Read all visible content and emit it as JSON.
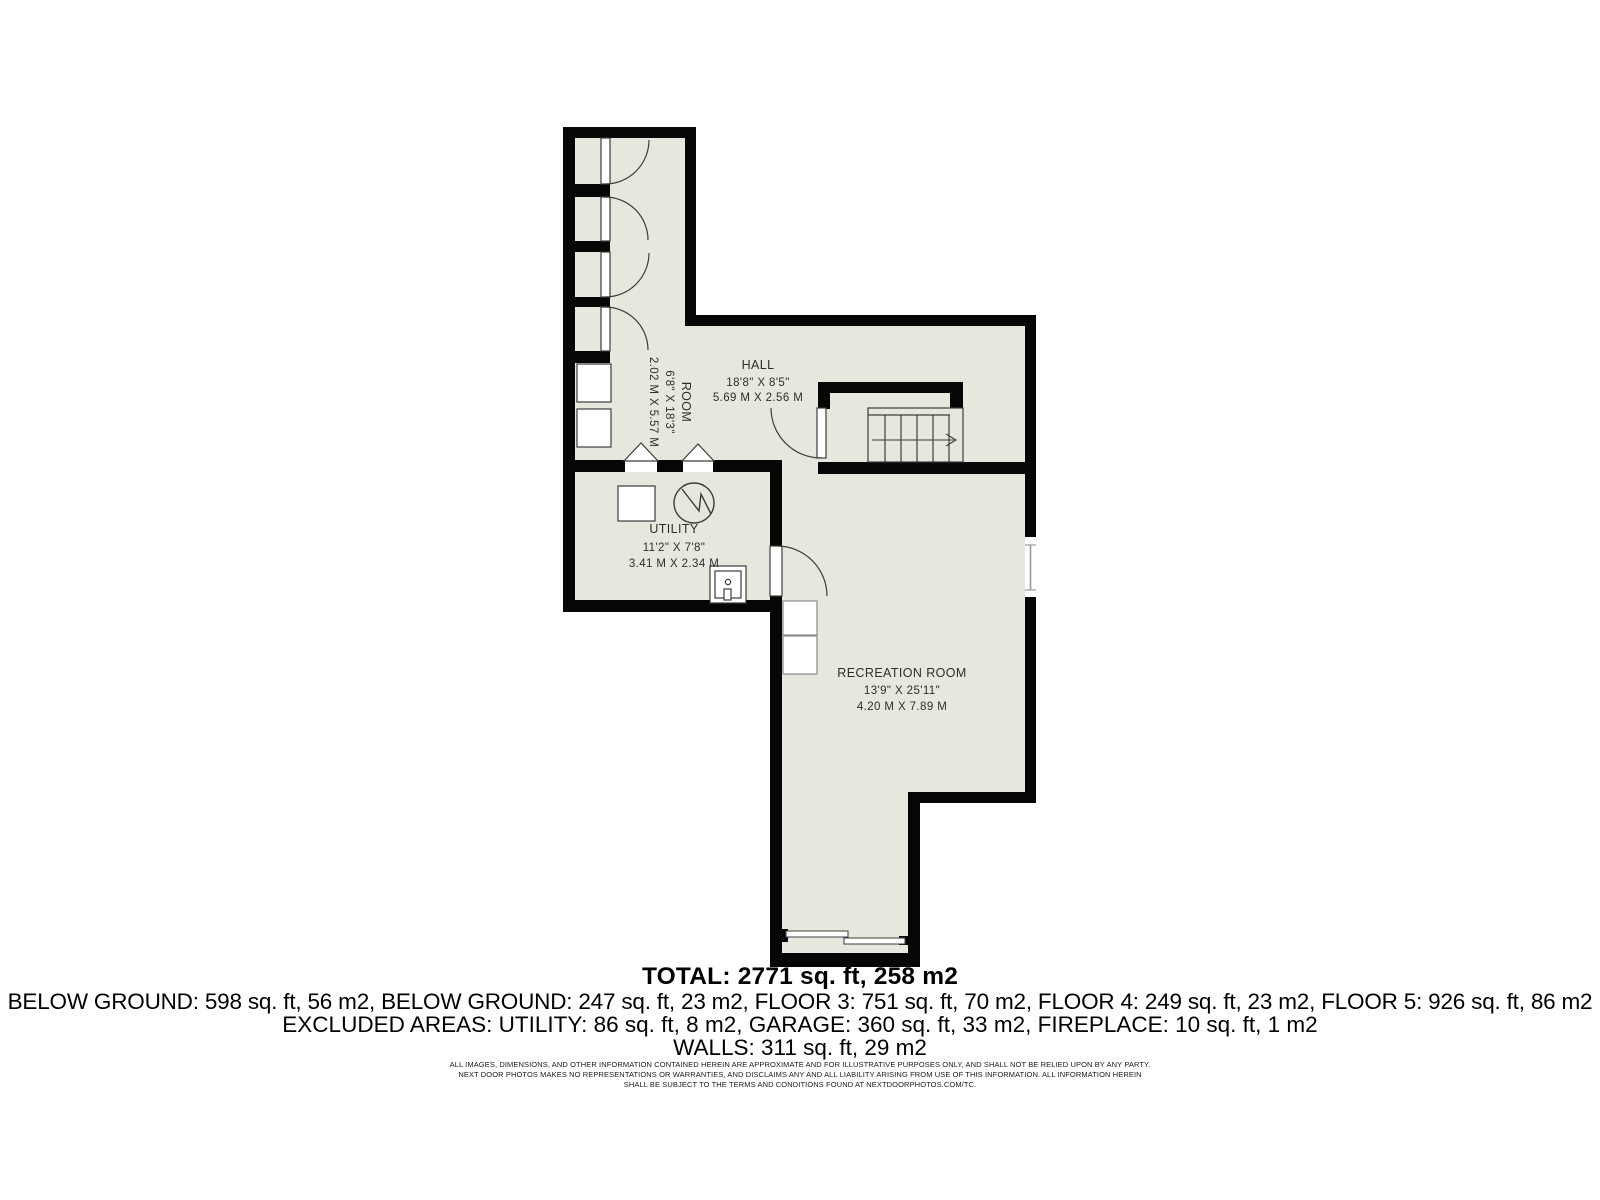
{
  "plan": {
    "colors": {
      "wall": "#060606",
      "floor": "#e8e7de",
      "line": "#3c3c3c",
      "fixture_fill": "#ffffff",
      "label": "#2e2e2e"
    },
    "rooms": [
      {
        "name": "ROOM",
        "dim_imperial": "6'8\" X 18'3\"",
        "dim_metric": "2.02 M X 5.57 M"
      },
      {
        "name": "HALL",
        "dim_imperial": "18'8\" X 8'5\"",
        "dim_metric": "5.69 M X 2.56 M"
      },
      {
        "name": "UTILITY",
        "dim_imperial": "11'2\" X 7'8\"",
        "dim_metric": "3.41 M X 2.34 M"
      },
      {
        "name": "RECREATION ROOM",
        "dim_imperial": "13'9\" X 25'11\"",
        "dim_metric": "4.20 M X 7.89 M"
      }
    ]
  },
  "summary": {
    "total": "TOTAL: 2771 sq. ft, 258 m2",
    "floors": "BELOW GROUND: 598 sq. ft, 56 m2, BELOW GROUND: 247 sq. ft, 23 m2, FLOOR 3: 751 sq. ft, 70 m2, FLOOR 4: 249 sq. ft, 23 m2, FLOOR 5: 926 sq. ft, 86 m2",
    "excluded": "EXCLUDED AREAS: UTILITY: 86 sq. ft, 8 m2, GARAGE: 360 sq. ft, 33 m2, FIREPLACE: 10 sq. ft, 1 m2",
    "walls": "WALLS: 311 sq. ft, 29 m2"
  },
  "disclaimer": {
    "line1": "ALL IMAGES, DIMENSIONS, AND OTHER INFORMATION CONTAINED HEREIN ARE APPROXIMATE AND FOR ILLUSTRATIVE PURPOSES ONLY, AND SHALL NOT BE RELIED UPON BY ANY PARTY.",
    "line2": "NEXT DOOR PHOTOS MAKES NO REPRESENTATIONS OR WARRANTIES, AND DISCLAIMS ANY AND ALL LIABILITY ARISING FROM USE OF THIS INFORMATION. ALL INFORMATION HEREIN",
    "line3": "SHALL BE SUBJECT TO THE TERMS AND CONDITIONS FOUND AT NEXTDOORPHOTOS.COM/TC."
  }
}
